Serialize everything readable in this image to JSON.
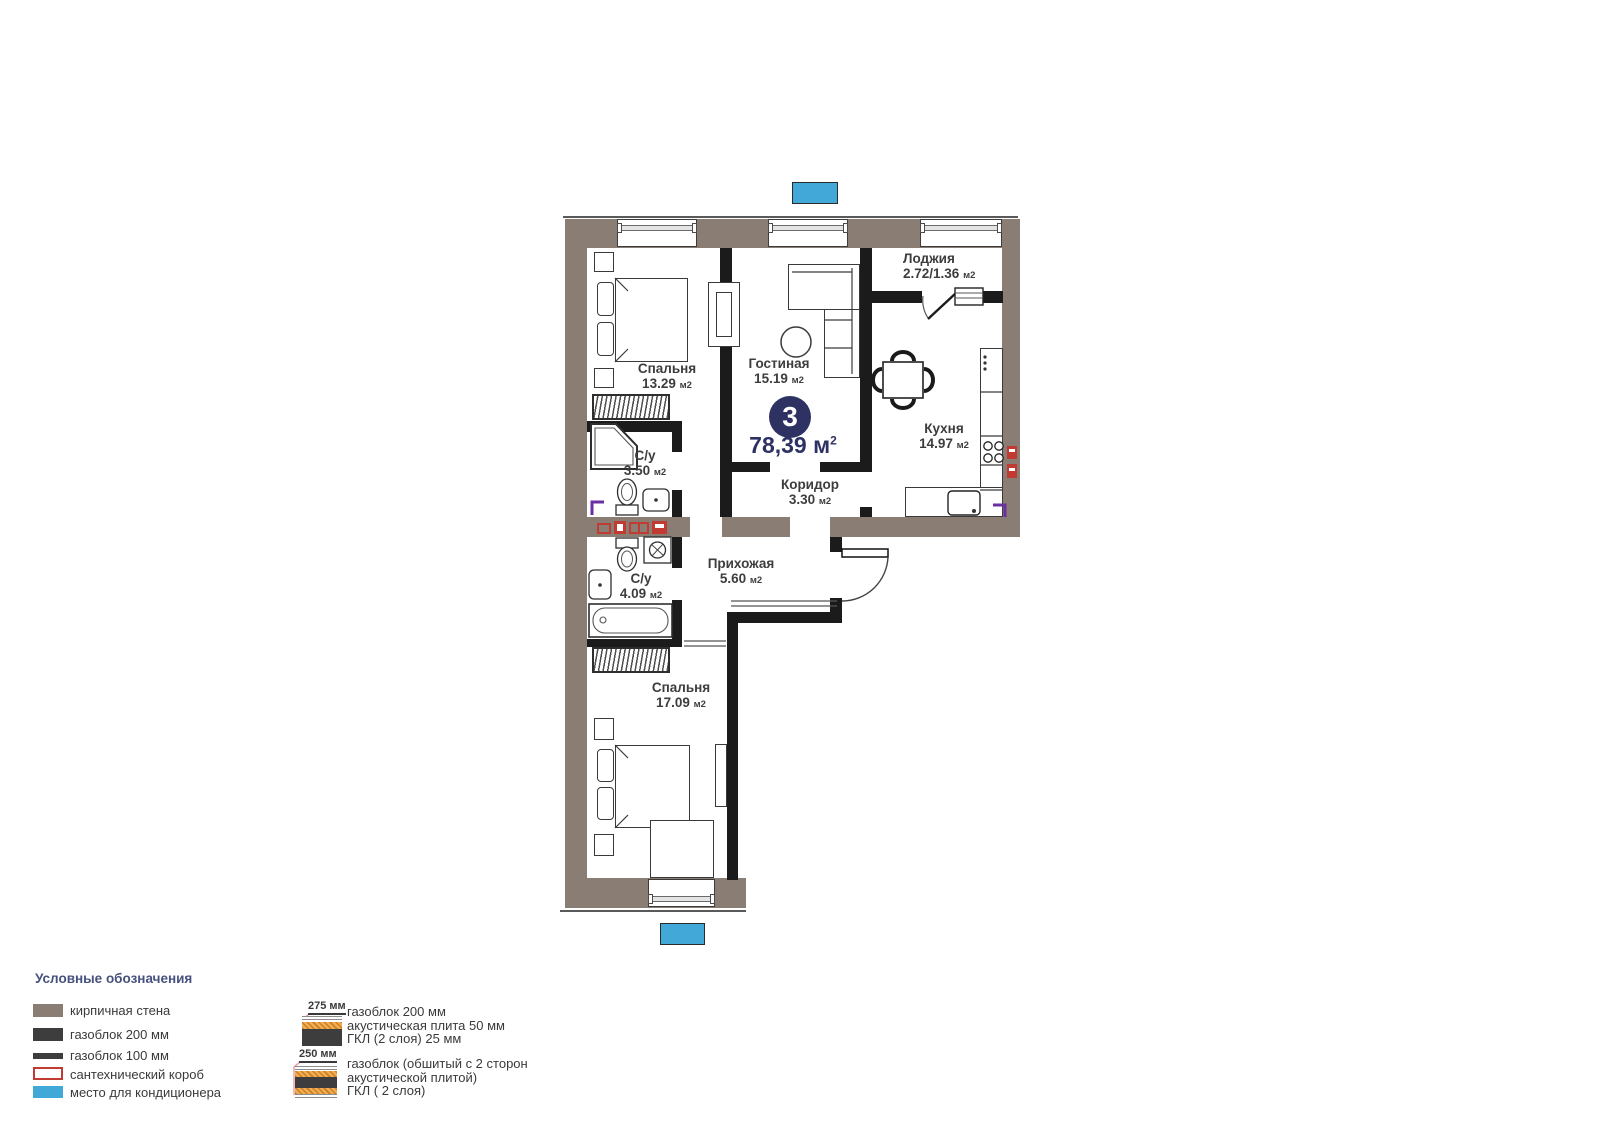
{
  "plan": {
    "unit_number": "3",
    "total_area": "78,39",
    "total_area_unit": "м",
    "total_area_sup": "2",
    "area_unit": "м2",
    "rooms": {
      "bedroom1": {
        "name": "Спальня",
        "area": "13.29"
      },
      "living": {
        "name": "Гостиная",
        "area": "15.19"
      },
      "loggia": {
        "name": "Лоджия",
        "area": "2.72/1.36"
      },
      "kitchen": {
        "name": "Кухня",
        "area": "14.97"
      },
      "bath1": {
        "name": "С/у",
        "area": "3.50"
      },
      "corridor": {
        "name": "Коридор",
        "area": "3.30"
      },
      "bath2": {
        "name": "С/у",
        "area": "4.09"
      },
      "hall": {
        "name": "Прихожая",
        "area": "5.60"
      },
      "bedroom2": {
        "name": "Спальня",
        "area": "17.09"
      }
    }
  },
  "legend": {
    "title": "Условные обозначения",
    "items": [
      {
        "id": "brick-wall",
        "label": "кирпичная стена",
        "color": "#8a7d73"
      },
      {
        "id": "gasblock-200",
        "label": "газоблок 200 мм",
        "color": "#3d3d3d"
      },
      {
        "id": "gasblock-100",
        "label": "газоблок 100 мм",
        "color": "#3d3d3d"
      },
      {
        "id": "plumbing-box",
        "label": "сантехнический короб",
        "color": "#c23b33"
      },
      {
        "id": "ac-place",
        "label": "место для кондиционера",
        "color": "#41a8d8"
      }
    ],
    "wall_types": [
      {
        "dimension": "275 мм",
        "line1": "газоблок 200 мм",
        "line2": "акустическая плита 50 мм",
        "line3": "ГКЛ (2 слоя) 25 мм"
      },
      {
        "dimension": "250 мм",
        "line1": "газоблок (обшитый с 2 сторон",
        "line2": "акустической плитой)",
        "line3": "ГКЛ ( 2 слоя)"
      }
    ]
  },
  "colors": {
    "accent": "#2d3263",
    "brick": "#8a7d73",
    "plumbing": "#c23b33",
    "ac": "#41a8d8"
  }
}
